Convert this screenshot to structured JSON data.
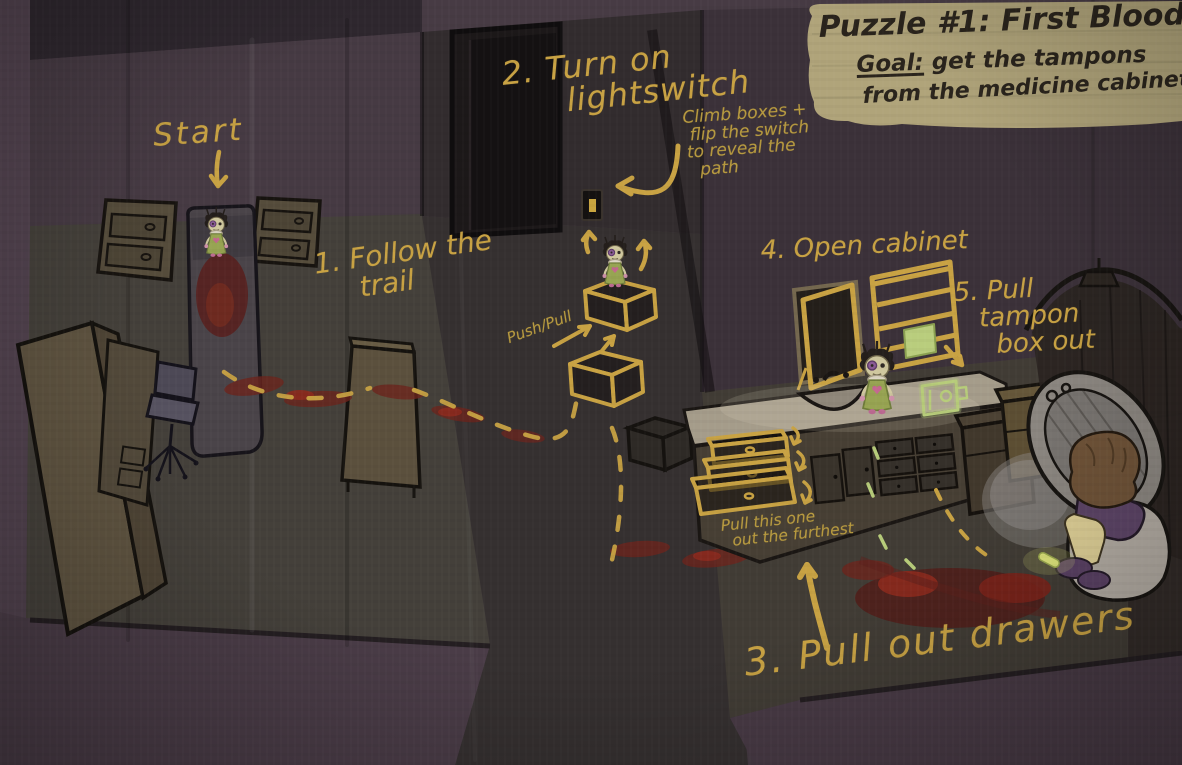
{
  "title_card": {
    "title": "Puzzle #1: First Blood",
    "goal_label": "Goal:",
    "goal_line1": "get the tampons",
    "goal_line2": "from the medicine cabinet",
    "bg_color": "#b0a47a",
    "text_color": "#2a241c"
  },
  "annotations": {
    "start": {
      "label": "Start"
    },
    "step1": {
      "line1": "1. Follow the",
      "line2": "trail"
    },
    "step2": {
      "line1": "2. Turn on",
      "line2": "lightswitch",
      "note1": "Climb boxes +",
      "note2": "flip the switch",
      "note3": "to reveal the",
      "note4": "path"
    },
    "push_pull": {
      "label": "Push/Pull"
    },
    "step3": {
      "label": "3. Pull out drawers",
      "note1": "Pull this one",
      "note2": "out the furthest"
    },
    "step4": {
      "label": "4. Open cabinet"
    },
    "step5": {
      "line1": "5. Pull",
      "line2": "tampon",
      "line3": "box out"
    }
  },
  "scene": {
    "rooms": [
      "bedroom",
      "hallway",
      "bathroom"
    ],
    "characters": [
      "doll-girl-on-bed",
      "doll-girl-on-crate",
      "doll-girl-on-counter",
      "person-on-toilet"
    ],
    "objects": [
      "bed-with-blood",
      "nightstand-left",
      "nightstand-right",
      "wardrobe",
      "desk",
      "office-chair",
      "blood-trail",
      "dresser",
      "doorway",
      "light-switch",
      "push-pull-crates",
      "mirror",
      "medicine-cabinet",
      "tampon-box",
      "sink",
      "vanity-counter",
      "pulled-drawers",
      "hamper",
      "shower",
      "toilet",
      "bath-rug",
      "wooden-crate",
      "glow-stick"
    ]
  },
  "colors": {
    "annotation_yellow": "#c8a243",
    "note_yellow": "#b79a3f",
    "blood_red": "#6b241d",
    "glow_green": "#b7cc7a",
    "wall_purple": "#453a42",
    "floor_dark": "#44403a",
    "hall_floor": "#353030"
  }
}
